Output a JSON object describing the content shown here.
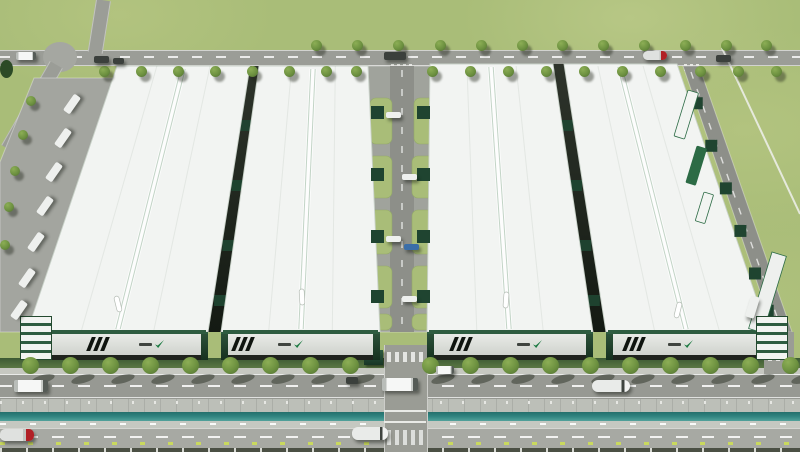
{
  "meta": {
    "subject": "Aerial 3D rendering of an industrial logistics park: four large white-roofed warehouses with green brand accents, a central internal road with loading docks, perimeter access roads with trees and container trucks, and a tree-lined boulevard with a canal in the foreground",
    "width": 800,
    "height": 452
  },
  "palette": {
    "grass": "#a9bd78",
    "road": "#9b9d97",
    "apron": "#a3a59f",
    "inner_road": "#8d8f89",
    "roof": "#f2f4f2",
    "roof_edge": "#c9d2c9",
    "ridge": "#c2d4c6",
    "facade_light": "#e9ebe7",
    "facade_dark": "#c9cdc7",
    "plinth": "#1f231d",
    "accent_green": "#2e5c40",
    "dock_green": "#1f4430",
    "hedge": "#3c5a33",
    "tree": "#6d9140",
    "canal": "#2f827e",
    "embankment": "#bcbfb8",
    "boulevard": "#979993",
    "bottom_road": "#a7a9a3",
    "truck_white": "#f4f5f4",
    "truck_red": "#b12026",
    "stud_yellow": "#c9d95e"
  },
  "buildings": [
    {
      "name": "warehouse-1",
      "roof_poly": "117,66 250,66 208,332 27,332",
      "ridge": [
        183,
        69,
        118,
        329
      ],
      "skylight": [
        118,
        304,
        -14
      ],
      "facade": {
        "x": 27,
        "w": 181,
        "stripe_frac": 0.34,
        "logo_frac": 0.62,
        "stripes": 3,
        "logo": "green-swoosh-emblem",
        "end_caps": [
          "office-left",
          "dark-right"
        ]
      }
    },
    {
      "name": "warehouse-2",
      "roof_poly": "259,66 368,66 380,332 221,332",
      "ridge": [
        313,
        69,
        301,
        329
      ],
      "skylight": [
        302,
        297,
        -3
      ],
      "facade": {
        "x": 221,
        "w": 159,
        "stripe_frac": 0.08,
        "logo_frac": 0.36,
        "stripes": 3,
        "logo": "green-swoosh-emblem",
        "end_caps": [
          "dark-left",
          "dark-right"
        ]
      }
    },
    {
      "name": "warehouse-3",
      "roof_poly": "430,64 553,64 593,332 427,332",
      "ridge": [
        491,
        67,
        509,
        329
      ],
      "skylight": [
        506,
        300,
        4
      ],
      "facade": {
        "x": 427,
        "w": 166,
        "stripe_frac": 0.15,
        "logo_frac": 0.54,
        "stripes": 3,
        "logo": "green-swoosh-emblem",
        "end_caps": [
          "dark-left",
          "dark-right"
        ]
      }
    },
    {
      "name": "warehouse-4",
      "roof_poly": "564,64 677,64 768,332 606,332",
      "ridge": [
        620,
        67,
        686,
        329
      ],
      "skylight": [
        678,
        310,
        14
      ],
      "facade": {
        "x": 606,
        "w": 162,
        "stripe_frac": 0.12,
        "logo_frac": 0.38,
        "stripes": 3,
        "logo": "green-swoosh-emblem",
        "end_caps": [
          "dark-left",
          "office-right"
        ]
      }
    }
  ],
  "gaps": [
    {
      "poly": "250,66 259,66 221,332 208,332",
      "dock_y": [
        120,
        180,
        240,
        295
      ],
      "cx_top": 254.5,
      "cx_bot": 214.5
    },
    {
      "poly": "553,64 564,64 606,332 593,332",
      "dock_y": [
        120,
        180,
        240,
        295
      ],
      "cx_top": 558.5,
      "cx_bot": 599.5
    }
  ],
  "left_apron": {
    "poly": "34,78 114,78 32,332 0,332 0,162",
    "trucks": [
      [
        62,
        100
      ],
      [
        53,
        134
      ],
      [
        44,
        168
      ],
      [
        35,
        202
      ],
      [
        26,
        238
      ],
      [
        17,
        274
      ],
      [
        9,
        306
      ]
    ],
    "trees": [
      [
        26,
        96
      ],
      [
        18,
        130
      ],
      [
        10,
        166
      ],
      [
        4,
        202
      ],
      [
        0,
        240
      ]
    ]
  },
  "corridor": {
    "poly": "368,66 430,66 427,332 380,332",
    "road": {
      "x": 390,
      "y": 66,
      "w": 24,
      "h": 266
    },
    "grass_patches": [
      [
        370,
        98,
        22,
        46
      ],
      [
        414,
        98,
        24,
        46
      ],
      [
        368,
        156,
        24,
        42
      ],
      [
        412,
        156,
        26,
        42
      ],
      [
        368,
        210,
        24,
        44
      ],
      [
        412,
        210,
        26,
        44
      ],
      [
        368,
        266,
        24,
        42
      ],
      [
        412,
        266,
        26,
        42
      ],
      [
        369,
        314,
        23,
        16
      ],
      [
        412,
        314,
        26,
        16
      ]
    ],
    "docks_left_y": [
      106,
      168,
      230,
      290
    ],
    "docks_right_y": [
      106,
      168,
      230,
      290
    ],
    "trucks": [
      [
        386,
        112,
        "white"
      ],
      [
        402,
        174,
        "white"
      ],
      [
        386,
        236,
        "white"
      ],
      [
        404,
        244,
        "blue"
      ],
      [
        402,
        296,
        "white"
      ]
    ]
  },
  "right_road": {
    "poly": "683,66 699,66 792,332 774,332",
    "dash_line": [
      691,
      72,
      781,
      328
    ],
    "edge_line": [
      677,
      66,
      768,
      332
    ],
    "dock_ts": [
      0.14,
      0.3,
      0.46,
      0.62,
      0.78,
      0.92
    ],
    "containers": [
      {
        "x": 688,
        "y": 90,
        "w": 11,
        "h": 48,
        "rot": 17,
        "c": "white"
      },
      {
        "x": 697,
        "y": 146,
        "w": 10,
        "h": 38,
        "rot": 17,
        "c": "green"
      },
      {
        "x": 704,
        "y": 192,
        "w": 10,
        "h": 30,
        "rot": 17,
        "c": "white"
      }
    ],
    "canopy": {
      "x": 772,
      "y": 252,
      "w": 15,
      "h": 80,
      "rot": 17
    },
    "truck": [
      748,
      296,
      17
    ],
    "path_line": [
      722,
      48,
      800,
      214
    ]
  },
  "top_road": {
    "y": 50,
    "h": 14,
    "roundabout": [
      60,
      57,
      17
    ],
    "crosswalks": [
      [
        391,
        64,
        23
      ],
      [
        684,
        64,
        16
      ]
    ],
    "trees_above": [
      316,
      357,
      398,
      440,
      481,
      522,
      562,
      603,
      644,
      685,
      726,
      766
    ],
    "trees_below": [
      104,
      141,
      178,
      215,
      252,
      289,
      326,
      356,
      432,
      470,
      508,
      546,
      584,
      622,
      660,
      700,
      738,
      776
    ],
    "trucks": [
      {
        "x": 16,
        "y": 52,
        "w": 20,
        "h": 8,
        "t": "box"
      },
      {
        "x": 94,
        "y": 56,
        "w": 15,
        "h": 7,
        "t": "dark"
      },
      {
        "x": 113,
        "y": 58,
        "w": 11,
        "h": 6,
        "t": "dark"
      },
      {
        "x": 384,
        "y": 52,
        "w": 22,
        "h": 8,
        "t": "dark"
      },
      {
        "x": 643,
        "y": 51,
        "w": 24,
        "h": 9,
        "t": "redtanker"
      },
      {
        "x": 716,
        "y": 55,
        "w": 15,
        "h": 7,
        "t": "dark"
      }
    ]
  },
  "frontage": {
    "hedge_segments": [
      [
        0,
        384
      ],
      [
        426,
        338
      ],
      [
        794,
        6
      ]
    ],
    "hedge_y": 358,
    "hedge_h": 10,
    "sidewalk_y": 368,
    "sidewalk_h": 6,
    "tree_xs": [
      30,
      70,
      110,
      150,
      190,
      230,
      270,
      310,
      350,
      430,
      470,
      510,
      550,
      590,
      630,
      670,
      710,
      750,
      790
    ],
    "tree_y": 357
  },
  "boulevard": {
    "y": 374,
    "h": 25,
    "vehicles": [
      {
        "x": 14,
        "y": 380,
        "w": 34,
        "h": 12,
        "t": "box"
      },
      {
        "x": 382,
        "y": 378,
        "w": 36,
        "h": 13,
        "t": "box"
      },
      {
        "x": 592,
        "y": 380,
        "w": 38,
        "h": 12,
        "t": "tanker"
      },
      {
        "x": 436,
        "y": 366,
        "w": 18,
        "h": 8,
        "t": "box"
      },
      {
        "x": 346,
        "y": 377,
        "w": 12,
        "h": 7,
        "t": "dark"
      }
    ]
  },
  "embankment": {
    "y": 399,
    "h": 13
  },
  "canal": {
    "y": 412,
    "h": 9
  },
  "lower_embankment": {
    "y": 421,
    "h": 7
  },
  "bottom_road": {
    "y": 428,
    "h": 20,
    "vehicles": [
      {
        "x": 0,
        "y": 429,
        "w": 34,
        "h": 12,
        "t": "redtanker"
      },
      {
        "x": 352,
        "y": 427,
        "w": 36,
        "h": 13,
        "t": "tanker"
      }
    ],
    "studs_y": 442,
    "stud_step": 28
  },
  "bottom_strip": {
    "y": 448,
    "h": 4
  },
  "entrance": {
    "x": 384,
    "w": 42,
    "top": 345,
    "gatehouse": [
      364,
      350,
      19,
      15
    ],
    "crosswalk1_y": 352,
    "crosswalk2_y": 430
  },
  "right_junction": {
    "x": 764,
    "w": 30,
    "crosswalk_y": 352
  }
}
